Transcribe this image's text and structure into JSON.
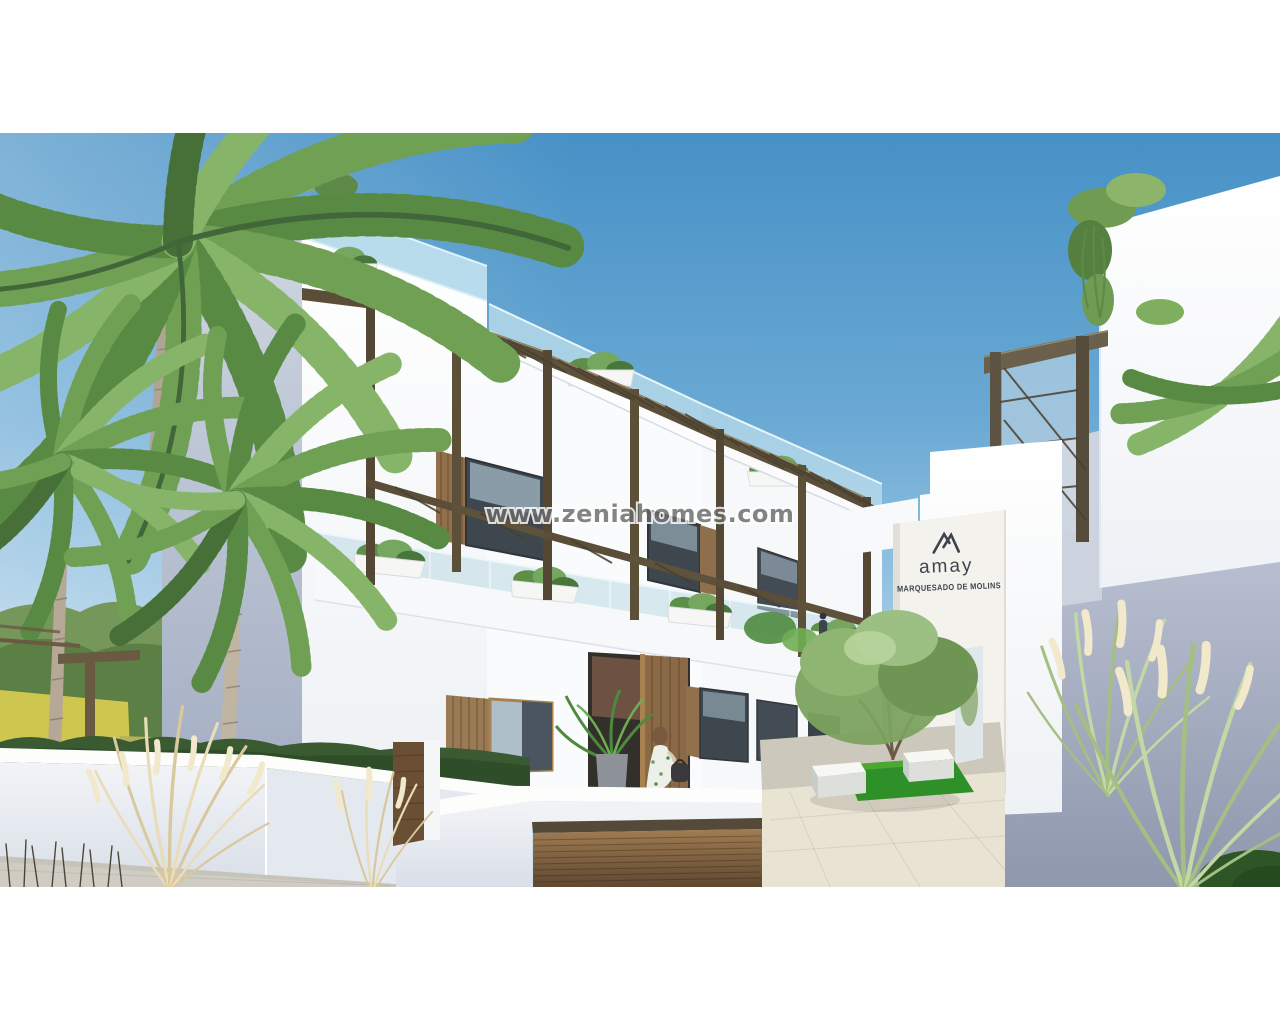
{
  "image": {
    "kind": "real-estate architectural rendering photo",
    "caption": "White modern apartment complex with wooden pergolas, roof terraces, palm trees, ornamental grasses, landscaped courtyard and entrance sign wall under a clear blue sky"
  },
  "watermark": {
    "text": "www.zeniahomes.com"
  },
  "sign": {
    "brand": "amay",
    "development": "MARQUESADO DE MOLINS"
  },
  "scene_objects": [
    "blue-sky",
    "palm-trees",
    "main-apartment-building",
    "roof-glass-balustrades",
    "wooden-pergolas",
    "terrace-planters",
    "right-building",
    "entrance-sign-wall",
    "courtyard-garden",
    "white-benches",
    "grass-patch",
    "courtyard-tree",
    "pampas-grass",
    "garage-wood-door",
    "white-planter-wall",
    "woman-walking",
    "distant-field-and-trees"
  ],
  "colors": {
    "sky_top": "#4791c6",
    "sky_low": "#c6deee",
    "building_lit": "#fbfcfd",
    "building_shade": "#aeb8ca",
    "glass_balustrade": "#badbe8",
    "pergola_wood": "#554937",
    "slat_wood": "#8f6e4a",
    "garage_wood_dark": "#5d4731",
    "field_yellow": "#c9c355",
    "hedge_green": "#3a5a31",
    "lawn_green": "#2f8f28",
    "palm_green": "#6fa054",
    "pampas_cream": "#ecdfbd",
    "pavement_sun": "#e9e3d3",
    "pavement_shade": "#c8c4b8",
    "watermark_gray": "#6a6a6a",
    "sign_text": "#3e454f"
  }
}
